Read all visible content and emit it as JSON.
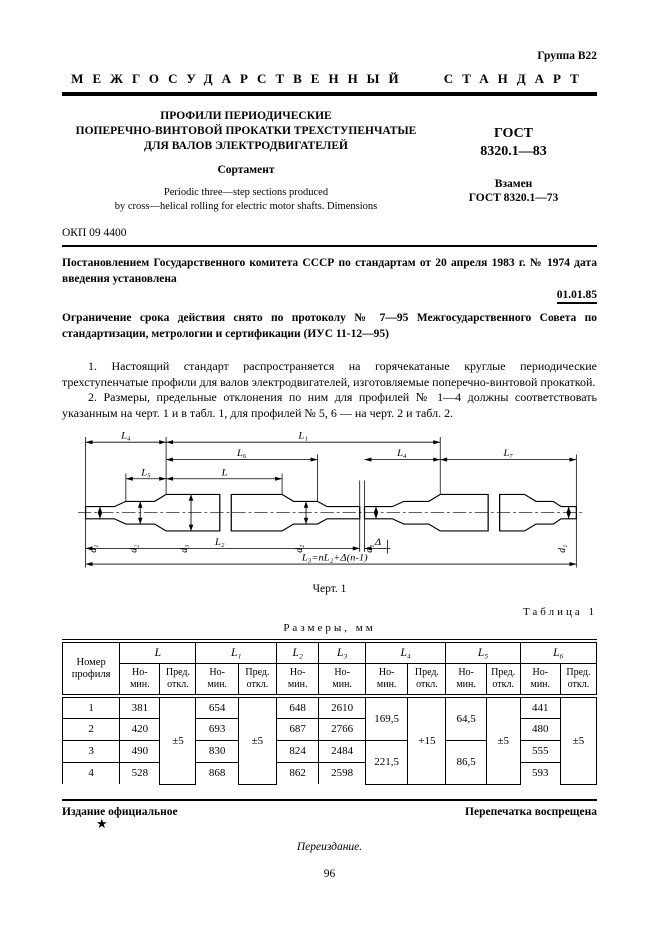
{
  "header": {
    "group": "Группа В22",
    "standard_type": "МЕЖГОСУДАРСТВЕННЫЙ СТАНДАРТ",
    "title_line1": "ПРОФИЛИ ПЕРИОДИЧЕСКИЕ",
    "title_line2": "ПОПЕРЕЧНО-ВИНТОВОЙ ПРОКАТКИ ТРЕХСТУПЕНЧАТЫЕ",
    "title_line3": "ДЛЯ ВАЛОВ ЭЛЕКТРОДВИГАТЕЛЕЙ",
    "subtitle": "Сортамент",
    "title_en_line1": "Periodic three—step sections produced",
    "title_en_line2": "by cross—helical rolling for electric motor shafts. Dimensions",
    "designation_label": "ГОСТ",
    "designation_number": "8320.1—83",
    "replaces_label": "Взамен",
    "replaces_number": "ГОСТ 8320.1—73",
    "okp": "ОКП 09 4400"
  },
  "decree": {
    "text": "Постановлением Государственного комитета СССР по стандартам от 20 апреля 1983 г. № 1974 дата введения установлена",
    "effective_date": "01.01.85",
    "limitation": "Ограничение срока действия снято по протоколу № 7—95 Межгосударственного Совета по стандартизации, метрологии и сертификации (ИУС 11-12—95)"
  },
  "body": {
    "para1": "1. Настоящий стандарт распространяется на горячекатаные круглые периодические трехступенчатые профили для валов электродвигателей, изготовляемые поперечно-винтовой прокаткой.",
    "para2": "2. Размеры, предельные отклонения по ним для профилей № 1—4 должны соответствовать указанным на черт. 1 и в табл. 1, для профилей № 5, 6 — на черт. 2 и табл. 2."
  },
  "drawing": {
    "caption": "Черт. 1",
    "labels": {
      "L4": "L₄",
      "L1": "L₁",
      "L6": "L₆",
      "L5": "L₅",
      "L": "L",
      "L4r": "L₄",
      "L7": "L₇",
      "L2": "L₂",
      "delta": "Δ",
      "L3_formula": "L₃=nL₂+Δ(n-1)",
      "d1": "d₁",
      "d2": "d₂",
      "d3": "d₃"
    }
  },
  "table1": {
    "caption": "Таблица 1",
    "units": "Размеры, мм",
    "profile_header": "Номер\nпрофиля",
    "groups": {
      "L": "L",
      "L1": "L₁",
      "L2": "L₂",
      "L3": "L₃",
      "L4": "L₄",
      "L5": "L₅",
      "L6": "L₆"
    },
    "sub_nominal": "Но-\nмин.",
    "sub_deviation": "Пред.\nоткл.",
    "rows": [
      {
        "num": "1",
        "L": "381",
        "L1": "654",
        "L2": "648",
        "L3": "2610",
        "L6": "441"
      },
      {
        "num": "2",
        "L": "420",
        "L1": "693",
        "L2": "687",
        "L3": "2766",
        "L6": "480"
      },
      {
        "num": "3",
        "L": "490",
        "L1": "830",
        "L2": "824",
        "L3": "2484",
        "L6": "555"
      },
      {
        "num": "4",
        "L": "528",
        "L1": "868",
        "L2": "862",
        "L3": "2598",
        "L6": "593"
      }
    ],
    "merged": {
      "L_dev": "±5",
      "L1_dev": "±5",
      "L4_rows12": "169,5",
      "L4_rows34": "221,5",
      "L4_dev": "+15",
      "L5_rows12": "64,5",
      "L5_rows34": "86,5",
      "L6_dev": "±5"
    }
  },
  "footer": {
    "official": "Издание официальное",
    "reprint": "Перепечатка воспрещена",
    "star": "★",
    "reissue": "Переиздание.",
    "page_number": "96"
  }
}
